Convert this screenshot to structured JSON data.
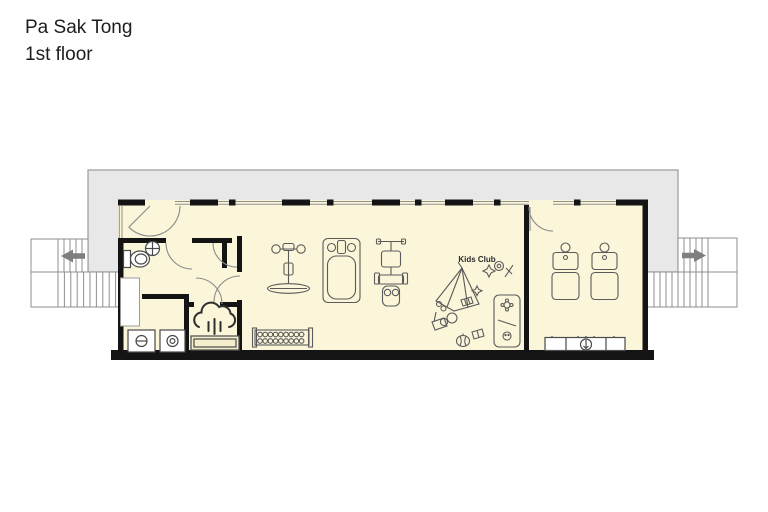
{
  "title": {
    "line1": "Pa Sak Tong",
    "line2": "1st floor"
  },
  "floorplan": {
    "labels": {
      "kids_club": "Kids Club"
    },
    "colors": {
      "floor": "#FBF6D9",
      "deck": "#E8E8E8",
      "wall": "#141414",
      "line": "#5a5a5a",
      "arrow": "#7f7f7f"
    },
    "stairs": {
      "left_direction": "left",
      "right_direction": "right"
    },
    "icons": {
      "toilet": "toilet-icon",
      "sink": "sink-icon",
      "washer": "washing-machine-icon",
      "dryer": "dryer-icon",
      "steam_room": "steam-cloud-icon",
      "exercise_bike": "exercise-bike-icon",
      "treadmill": "treadmill-icon",
      "weight_machine": "weight-machine-icon",
      "dumbbell_rack": "dumbbell-rack-icon",
      "massage_bed": "massage-bed-icon",
      "counter_sink": "counter-sink-icon",
      "toys": "kids-toys-icon"
    }
  }
}
